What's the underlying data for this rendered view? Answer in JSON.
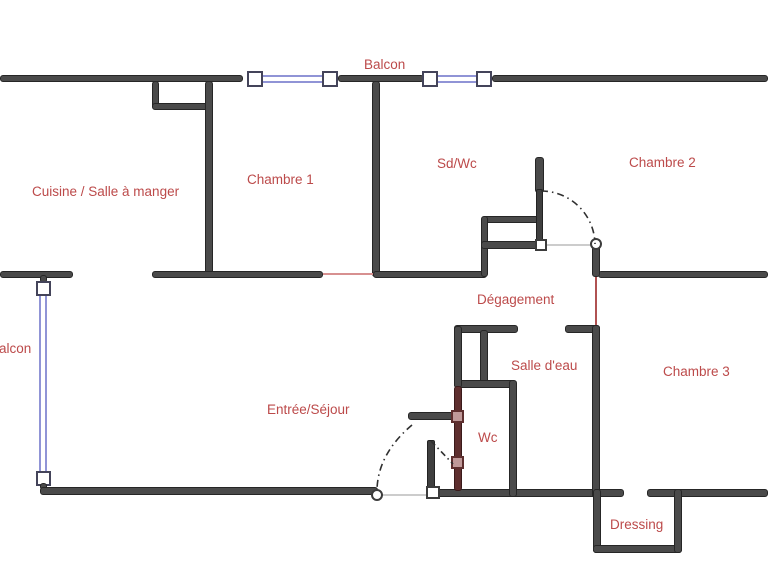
{
  "plan_title": "Apartment floor plan",
  "rooms": {
    "balcon_top": "Balcon",
    "cuisine": "Cuisine / Salle à manger",
    "chambre1": "Chambre 1",
    "sdwc": "Sd/Wc",
    "chambre2": "Chambre 2",
    "degagement": "Dégagement",
    "balcon_left": "Balcon",
    "entree": "Entrée/Séjour",
    "salle_deau": "Salle d'eau",
    "wc": "Wc",
    "chambre3": "Chambre 3",
    "dressing": "Dressing"
  },
  "colors": {
    "wall": "#4a4a4a",
    "modified_wall": "#5e2f2f",
    "room_label": "#bc4a4a",
    "window_blue": "#9094d6",
    "opening_red": "#d79090",
    "doorway_red": "#b05252",
    "background": "#ffffff"
  }
}
